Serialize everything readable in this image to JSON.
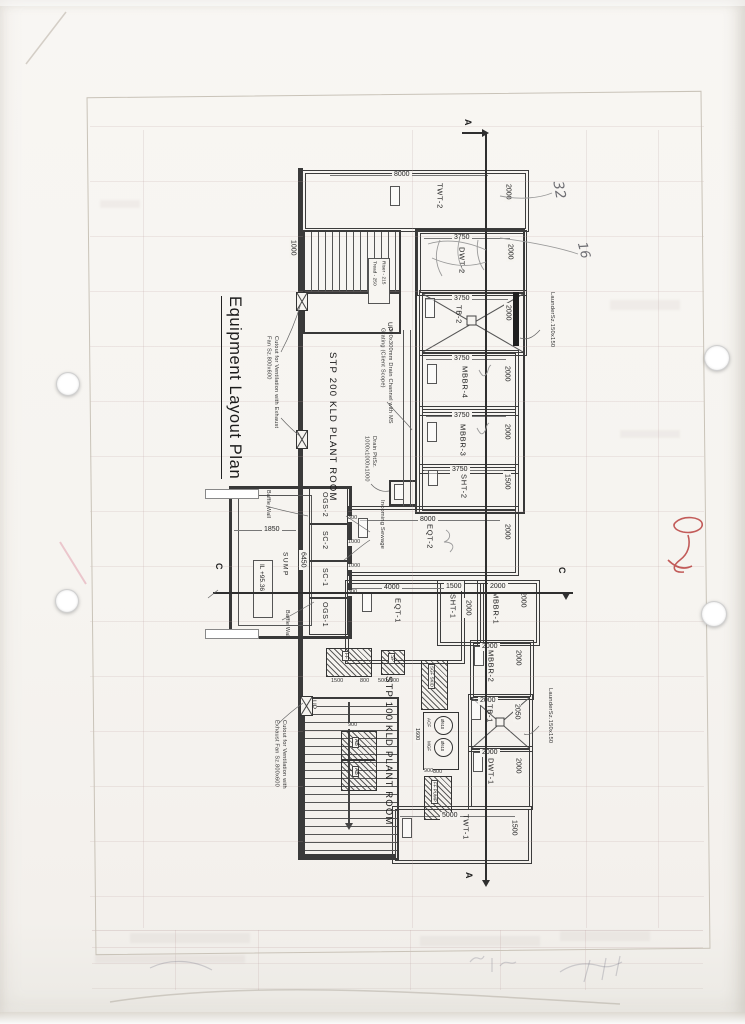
{
  "title": "Equipment Layout Plan",
  "handwritten": [
    "32",
    "16"
  ],
  "plan": {
    "plant_rooms": [
      "STP 200 KLD PLANT ROOM",
      "STP 100 KLD PLANT ROOM"
    ],
    "rooms": [
      {
        "label": "TWT-2",
        "len": "8000",
        "wid": "2000"
      },
      {
        "label": "DWT-2",
        "len": "3750",
        "wid": "2000"
      },
      {
        "label": "TB-2",
        "len": "3750",
        "wid": "2000"
      },
      {
        "label": "MBBR-4",
        "len": "3750",
        "wid": "2000"
      },
      {
        "label": "MBBR-3",
        "len": "3750",
        "wid": "2000"
      },
      {
        "label": "SHT-2",
        "len": "3750",
        "wid": "1500"
      },
      {
        "label": "EQT-2",
        "len": "8000",
        "wid": "2000"
      },
      {
        "label": "EQT-1",
        "len": "4000",
        "wid": ""
      },
      {
        "label": "SHT-1",
        "len": "1500",
        "wid": "2000"
      },
      {
        "label": "MBBR-1",
        "len": "2000",
        "wid": "2000"
      },
      {
        "label": "MBBR-2",
        "len": "2000",
        "wid": "2000"
      },
      {
        "label": "TB-1",
        "len": "2000",
        "wid": "2050"
      },
      {
        "label": "DWT-1",
        "len": "2000",
        "wid": "2000"
      },
      {
        "label": "TWT-1",
        "len": "5000",
        "wid": "1500"
      }
    ],
    "sump": {
      "cells": [
        "OGS-2",
        "SC-2",
        "SC-1",
        "OGS-1"
      ],
      "cell_dims": [
        "300",
        "1000",
        "1000",
        "300"
      ],
      "label": "SUMP",
      "level": "IL +95.36",
      "width_dim": "1850",
      "length_dim": "6450",
      "baffle_wall": "Baffle Wall"
    },
    "stairs": {
      "up": "UP",
      "tread": "Tread - 250",
      "riser": "Riser - 215",
      "corridor_dim": "1000"
    },
    "notes": {
      "vent": "Cutout for Ventilation with Exhaust Fan Sz.800x600",
      "drain_channel": "300x300mm Drain Channel with MS Grating (Client Scope)",
      "drain_pit": "Drain Pit",
      "drain_pit_size": "Sz. 1000x1000x1000",
      "launder": "Launder",
      "launder_size": "Sz.150x150",
      "incoming": "Incoming Sewage"
    },
    "sections": {
      "a": "A",
      "c": "C"
    },
    "equipment": {
      "ff": "FF",
      "sp": "SP",
      "ab": "AB",
      "acf": "ACF",
      "mgf": "MGF",
      "dia": "Ø610",
      "skid_top": "SGF SKID",
      "skid_bottom": "FF PUMP",
      "dims": {
        "ff_len": "1500",
        "ff_wid": "800",
        "sp": "500x500",
        "ab": "900",
        "filter_w": "800",
        "filter_l": "1600",
        "pump": "900"
      }
    }
  }
}
